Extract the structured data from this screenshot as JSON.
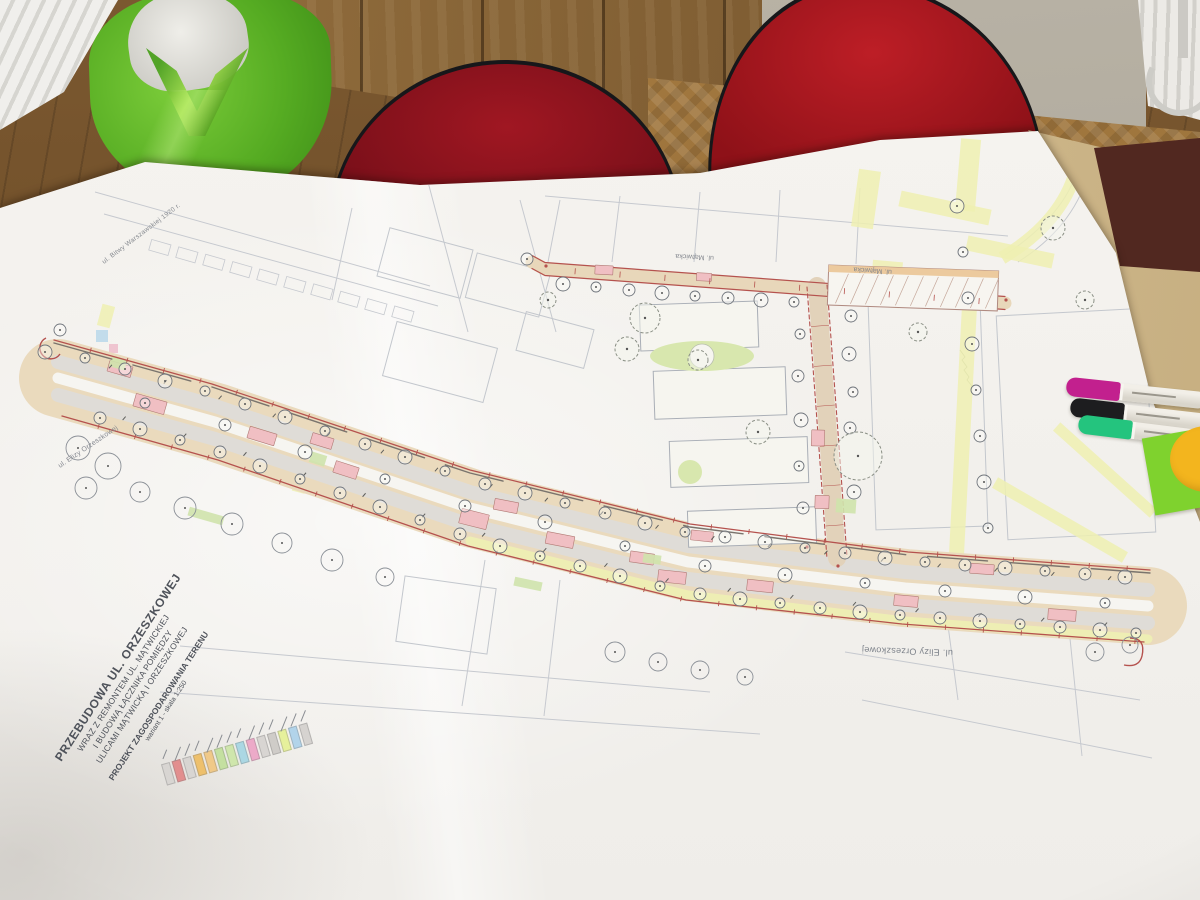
{
  "plan": {
    "title_block": {
      "line1": "PRZEBUDOWA UL. ORZESZKOWEJ",
      "line2": "WRAZ Z REMONTEM UL. MĄTWICKIEJ",
      "line3": "I BUDOWĄ ŁĄCZNIKA POMIĘDZY",
      "line4": "ULICAMI MĄTWICKĄ I ORZESZKOWEJ",
      "subtitle": "PROJEKT ZAGOSPODAROWANIA TERENU",
      "variant": "wariant 1 - skala 1:250"
    },
    "street_labels": {
      "orzeszkowej_main": "ul. Elizy Orzeszkowej",
      "orzeszkowej_left": "ul. Elizy Orzeszkowej",
      "bitwy_warszawskiej": "ul. Bitwy Warszawskiej 1920 r.",
      "matwicka_west": "ul. Mątwicka",
      "matwicka_east": "ul. Mątwicka"
    },
    "legend": {
      "swatch_colors": [
        "#d8d5d2",
        "#e28e8e",
        "#d8d5d2",
        "#eec06c",
        "#f0c988",
        "#c4e0a0",
        "#cfe6ac",
        "#abd7e3",
        "#ecaac8",
        "#d8d5d2",
        "#cfccc8",
        "#e6f09c",
        "#b2d4ea",
        "#d6d3d0"
      ]
    },
    "colors": {
      "road_fill": "#eadabd",
      "roadway_grey": "#dfdcd7",
      "parking_pink": "#f0bfc3",
      "greenery": "#cfe3ac",
      "highlight_yellow": "#eef0b2",
      "dimension_red": "#b5524e"
    }
  },
  "objects": {
    "markers": [
      {
        "name": "magenta-marker",
        "cap_color": "#c2208e"
      },
      {
        "name": "black-marker",
        "cap_color": "#1d1d1f"
      },
      {
        "name": "green-marker",
        "cap_color": "#24c47e"
      }
    ],
    "sticky_note_color": "#7fd22e",
    "sticker_color": "#f3b51e",
    "chair_color": "#a3161f",
    "bag_color": "#5fbf2b"
  }
}
